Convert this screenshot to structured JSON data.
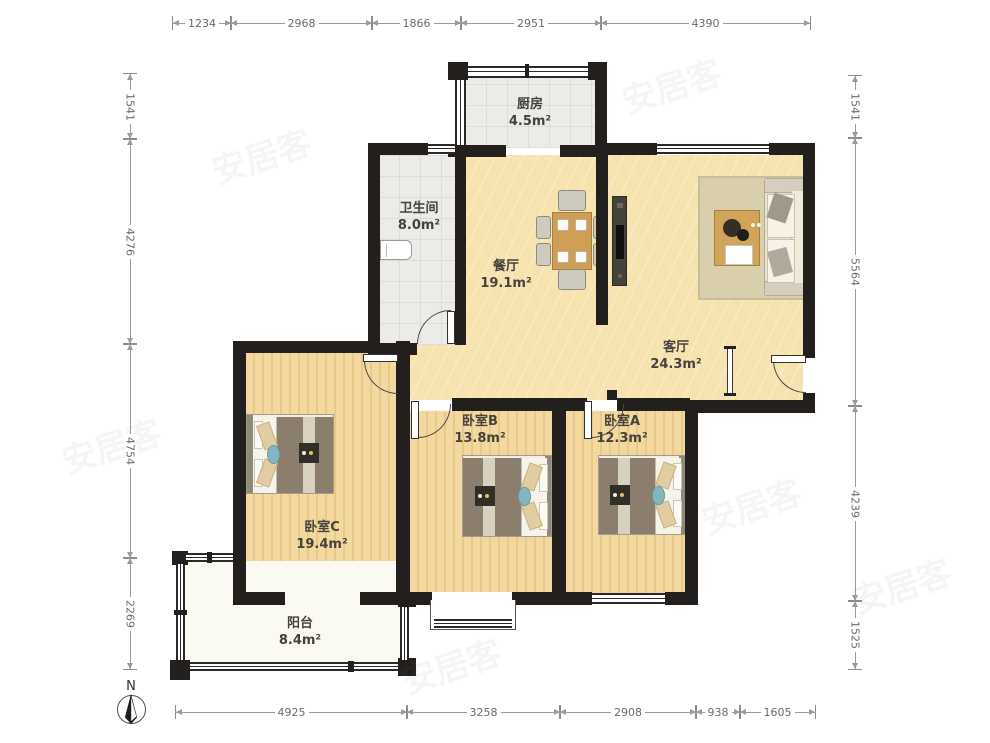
{
  "rooms": [
    {
      "name": "厨房",
      "area": "4.5m²"
    },
    {
      "name": "卫生间",
      "area": "8.0m²"
    },
    {
      "name": "餐厅",
      "area": "19.1m²"
    },
    {
      "name": "客厅",
      "area": "24.3m²"
    },
    {
      "name": "卧室B",
      "area": "13.8m²"
    },
    {
      "name": "卧室A",
      "area": "12.3m²"
    },
    {
      "name": "卧室C",
      "area": "19.4m²"
    },
    {
      "name": "阳台",
      "area": "8.4m²"
    }
  ],
  "dimensions": {
    "top": [
      "1234",
      "2968",
      "1866",
      "2951",
      "4390"
    ],
    "bottom": [
      "4925",
      "3258",
      "2908",
      "938",
      "1605"
    ],
    "left": [
      "1541",
      "4276",
      "4754",
      "2269"
    ],
    "right": [
      "1541",
      "5564",
      "4239",
      "1525"
    ]
  },
  "compass": {
    "label": "N"
  },
  "watermark": {
    "text": "安居客"
  },
  "colors": {
    "wall": "#221f1c",
    "wood_main": "#f6e3b0",
    "wood_bedroom": "#f0d298",
    "tile": "#ebebe7",
    "balcony_floor": "#fbfaf2",
    "dim_text": "#6b6b6b",
    "label_text": "#45423b"
  }
}
